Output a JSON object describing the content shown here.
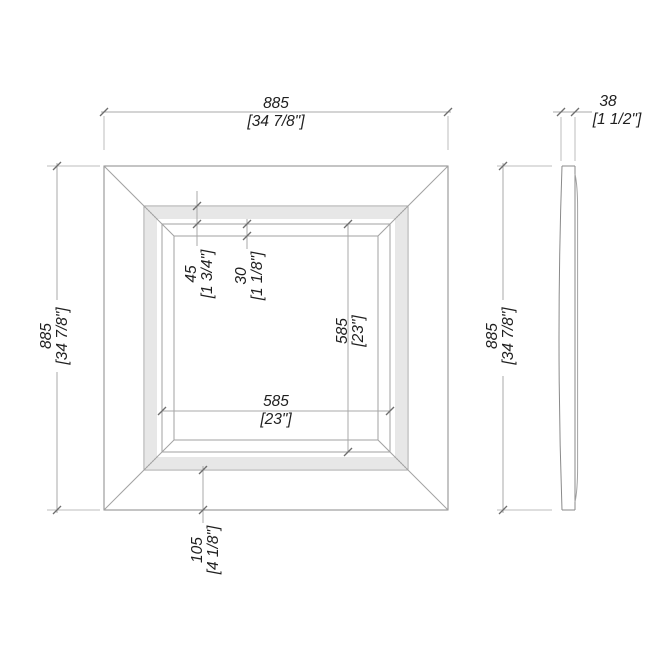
{
  "drawing": {
    "type": "technical-elevation",
    "subject": "square frame, front elevation and side profile",
    "units": "millimetres with inch conversions in brackets",
    "colors": {
      "line": "#8a8a8a",
      "fine_line": "#cfcfcf",
      "dim_line": "#a8a8a8",
      "text": "#1f1f1f",
      "background": "#ffffff"
    }
  },
  "dimensions": {
    "front_width": {
      "mm": "885",
      "in": "[34 7/8\"]"
    },
    "front_height": {
      "mm": "885",
      "in": "[34 7/8\"]"
    },
    "moulding_band": {
      "mm": "45",
      "in": "[1 3/4\"]"
    },
    "inner_bevel": {
      "mm": "30",
      "in": "[1 1/8\"]"
    },
    "opening_width": {
      "mm": "585",
      "in": "[23\"]"
    },
    "opening_height": {
      "mm": "585",
      "in": "[23\"]"
    },
    "face_border": {
      "mm": "105",
      "in": "[4 1/8\"]"
    },
    "side_thickness": {
      "mm": "38",
      "in": "[1 1/2\"]"
    },
    "side_height": {
      "mm": "885",
      "in": "[34 7/8\"]"
    }
  }
}
